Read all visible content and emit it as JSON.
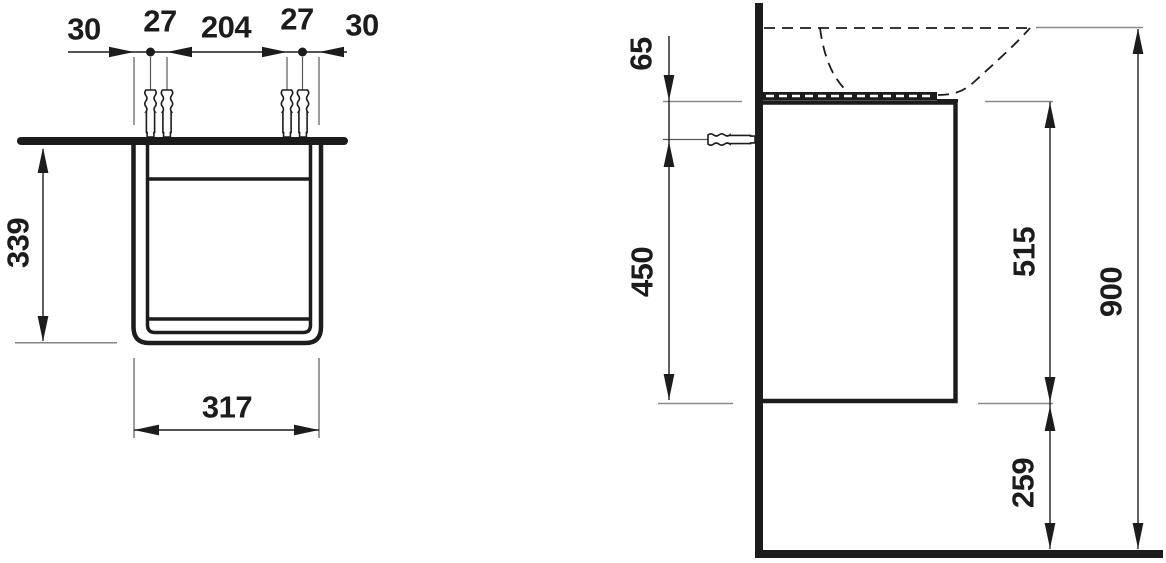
{
  "front_view": {
    "top_dims": {
      "d30_left": "30",
      "d27_left": "27",
      "d204_center": "204",
      "d27_right": "27",
      "d30_right": "30"
    },
    "height": "339",
    "width": "317"
  },
  "side_view": {
    "screw_offset_from_top": "65",
    "screw_to_bottom": "450",
    "carcass_height": "515",
    "total_height": "900",
    "floor_clearance": "259"
  },
  "colors": {
    "line": "#1c1c1c",
    "extension": "#8a8a8a"
  }
}
